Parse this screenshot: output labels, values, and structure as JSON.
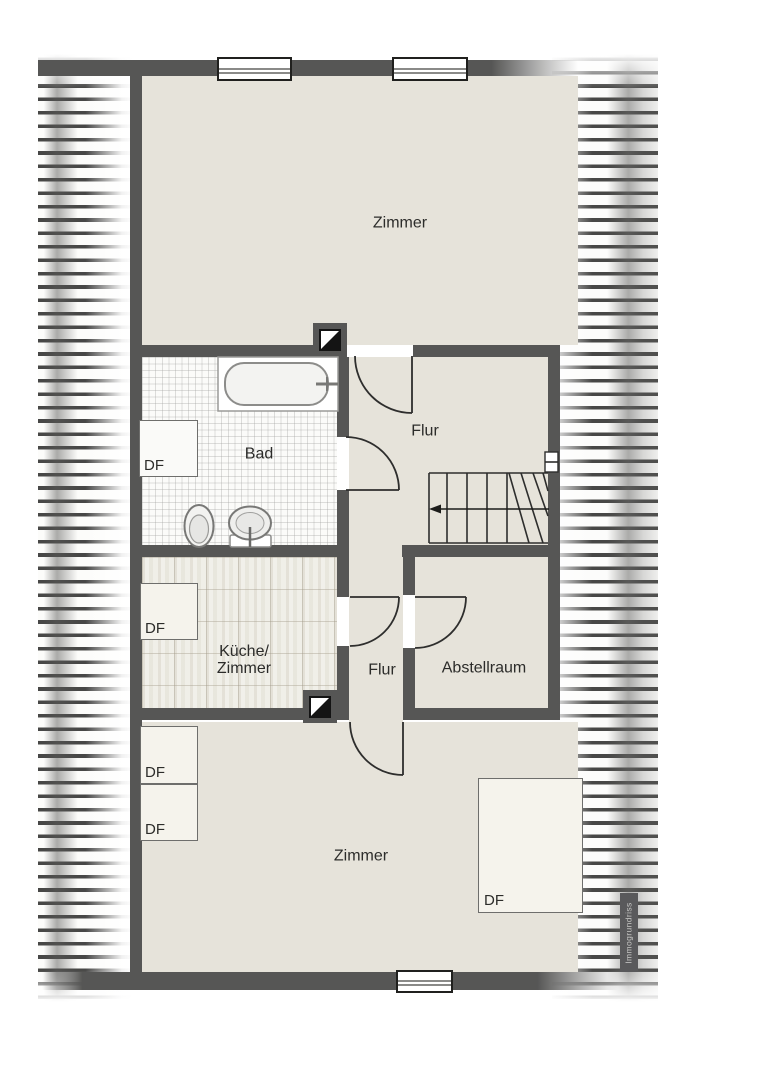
{
  "watermark": "Immogrundriss",
  "colors": {
    "wall": "#565655",
    "floor": "#e6e3da",
    "bad_floor": "#fbfbf9",
    "kueche_floor": "#edece4",
    "outline": "#2e2e2d",
    "badge_bg": "#59595b",
    "badge_text": "#c7c7c5"
  },
  "rooms": {
    "zimmer_top": "Zimmer",
    "bad": "Bad",
    "flur_upper": "Flur",
    "kueche_line1": "Küche/",
    "kueche_line2": "Zimmer",
    "flur_lower": "Flur",
    "abstellraum": "Abstellraum",
    "zimmer_bottom": "Zimmer"
  },
  "skylights": [
    {
      "id": "bad",
      "label": "DF"
    },
    {
      "id": "kueche",
      "label": "DF"
    },
    {
      "id": "zimmer_bottom_upper",
      "label": "DF"
    },
    {
      "id": "zimmer_bottom_lower",
      "label": "DF"
    },
    {
      "id": "zimmer_bottom_large",
      "label": "DF"
    }
  ]
}
